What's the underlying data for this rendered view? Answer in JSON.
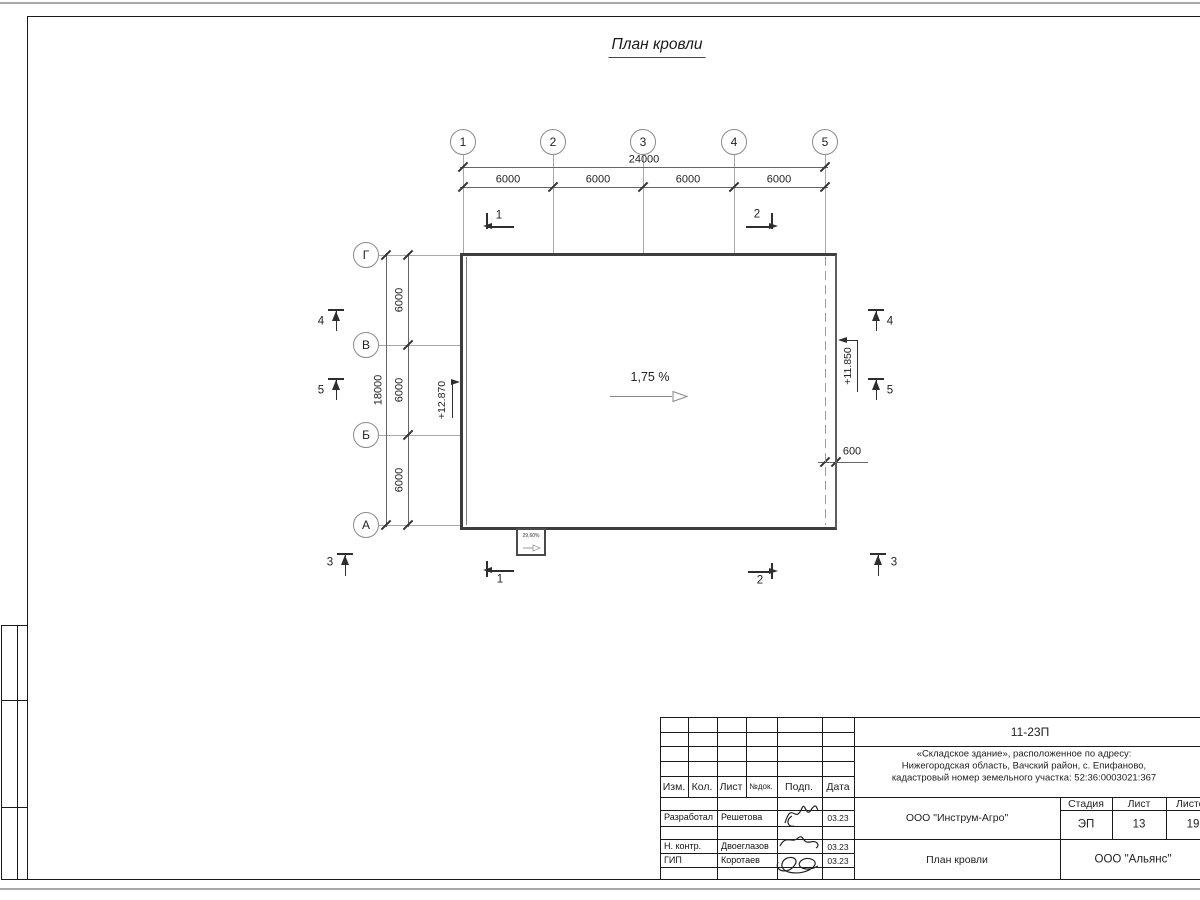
{
  "sheet_title": "План кровли",
  "plan": {
    "axes_top": [
      "1",
      "2",
      "3",
      "4",
      "5"
    ],
    "axes_left": [
      "Г",
      "В",
      "Б",
      "А"
    ],
    "dims": {
      "total_top": "24000",
      "bay": "6000",
      "total_left": "18000",
      "overhang": "600"
    },
    "slope_label": "1,75 %",
    "canopy_slope_label": "29,60%",
    "elevation_left": "+12.870",
    "elevation_right": "+11.850",
    "section_marks": {
      "s1": "1",
      "s2": "2",
      "s3": "3",
      "s4": "4",
      "s5": "5"
    }
  },
  "titleblock": {
    "doc_code": "11-23П",
    "project_lines": [
      "«Складское здание», расположенное по адресу:",
      "Нижегородская область, Вачский район, с. Епифаново,",
      "кадастровый номер земельного участка: 52:36:0003021:367"
    ],
    "columns": {
      "izm": "Изм.",
      "kol": "Кол.",
      "list": "Лист",
      "ndoc": "№док.",
      "podp": "Подп.",
      "data": "Дата"
    },
    "signers": [
      {
        "role": "Разработал",
        "name": "Решетова",
        "date": "03.23"
      },
      {
        "role": "Н. контр.",
        "name": "Двоеглазов",
        "date": "03.23"
      },
      {
        "role": "ГИП",
        "name": "Коротаев",
        "date": "03.23"
      }
    ],
    "designer_org": "ООО \"Инструм-Агро\"",
    "drawing_title": "План кровли",
    "stage_label": "Стадия",
    "stage_value": "ЭП",
    "sheet_label": "Лист",
    "sheet_value": "13",
    "sheets_label": "Листов",
    "sheets_value": "19",
    "customer_org": "ООО \"Альянс\""
  }
}
